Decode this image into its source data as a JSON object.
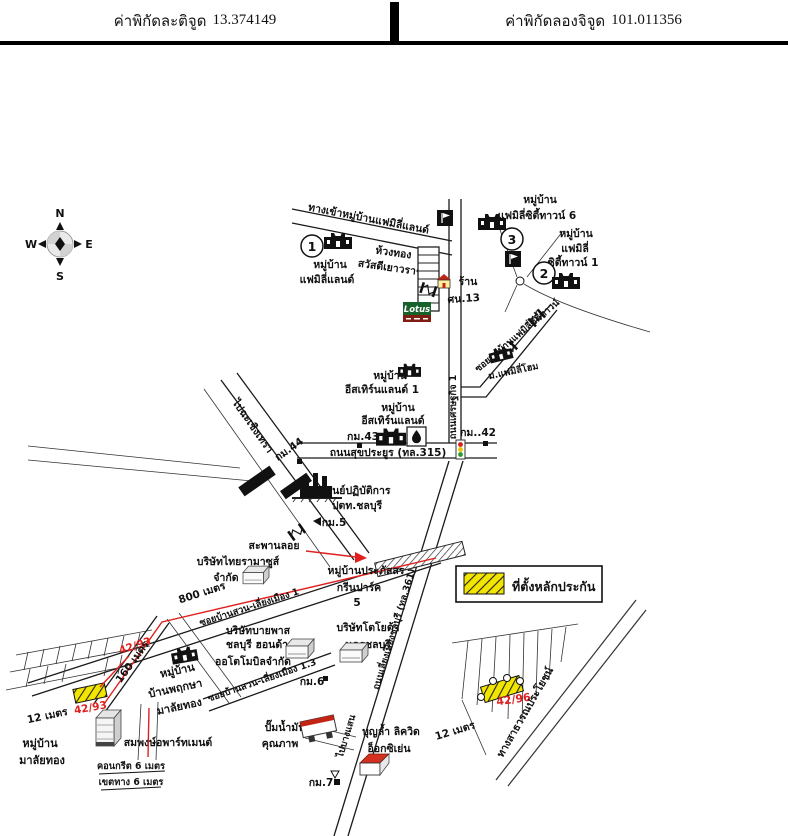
{
  "header": {
    "latitude_label": "ค่าพิกัดละติจูด",
    "latitude_value": "13.374149",
    "longitude_label": "ค่าพิกัดลองจิจูด",
    "longitude_value": "101.011356"
  },
  "compass": {
    "n": "N",
    "s": "S",
    "e": "E",
    "w": "W"
  },
  "legend": {
    "text": "ที่ตั้งหลักประกัน",
    "swatch": "yellow-hatched"
  },
  "colors": {
    "parcel_yellow": "#f2e500",
    "route_red": "#e02020",
    "lotus_green": "#17612a",
    "lotus_band_red": "#7e1d12",
    "signal_red": "#d42020",
    "signal_yellow": "#e8c800",
    "signal_green": "#2a9a2a"
  },
  "icons": {
    "compass_rose": "circle-with-diamond-and-4-arrows",
    "village": "black-gate-building-silhouette",
    "school": "white-pennant-on-black-square",
    "fuel_station": "black-drop-in-square",
    "traffic_light": "red-yellow-green-lights",
    "factory": "black-factory-with-chimneys",
    "km_marker": "black-square",
    "house_shop": "red-roof-house",
    "building_3d": "isometric-white-box",
    "overpass_bridge": "hatched-band",
    "road_break": "double-bar-zigzag"
  },
  "labels": {
    "entrance_road": "ทางเข้าหมู่บ้านแฟมิลี่แลนด์",
    "num1": "1",
    "num2": "2",
    "num3": "3",
    "family_land": [
      "หมู่บ้าน",
      "แฟมิลี่แลนด์"
    ],
    "huang_thong": "ห้วงทอง",
    "sawasdee_yaowarat": "สวัสดีเยาวราช",
    "shop": "ร้าน",
    "shop_no": "ศน.13",
    "lotus": "Lotus",
    "family_city6": [
      "หมู่บ้าน",
      "แฟมิลี่ซิตี้ทาวน์ 6"
    ],
    "family_city1": [
      "หมู่บ้าน",
      "แฟมิลี่",
      "ซิตี้ทาวน์ 1"
    ],
    "soi_family_city": "ซอยหมู่บ้านแฟมิลี่ซิตี้ทาวน์",
    "family_home": "ม.แฟมิลี่โฮม",
    "eastern_land_1": [
      "หมู่บ้าน",
      "อีสเทิร์นแลนด์ 1"
    ],
    "eastern_land": [
      "หมู่บ้าน",
      "อีสเทิร์นแลนด์"
    ],
    "km43": "กม.43",
    "km42": "กม..42",
    "km44": "กม.44",
    "km5": "กม.5",
    "km6": "กม.6",
    "km7": "กม.7",
    "sukprayoon_road": "ถนนสุขประยูร (ทล.315)",
    "setthakit_road": "ถนนเศรษฐกิจ 1",
    "to_chachoengsao": "ไปฉะเชิงเทรา",
    "ptt_center": [
      "ศูนย์ปฏิบัติการ",
      "ปตท.ชลบุรี"
    ],
    "overpass": "สะพานลอย",
    "thai_ramasus": [
      "บริษัทไทยรามาซูส์",
      "จำกัด"
    ],
    "m800": "800 เมตร",
    "soi_bansuan_1": "ซอยบ้านสวน-เลี่ยงเมือง 1",
    "prapatsorn": [
      "หมู่บ้านประภัสสร",
      "กรีนปาร์ค",
      "5"
    ],
    "bypass_honda": [
      "บริษัทบายพาส",
      "ชลบุรี ฮอนด้า",
      "ออโตโมบิลจำกัด"
    ],
    "toyota": [
      "บริษัทโตโยต้า",
      "นครชลบุรี"
    ],
    "soi_bansuan_13": "ซอยบ้านสวน-เลี่ยงเมือง 1.3",
    "liang_mueang_road": "ถนนเลี่ยงเมืองชลบุรี (ทล.361)",
    "gas_station": [
      "ปั๊มน้ำมัน",
      "คุณภาพ"
    ],
    "boonlam": [
      "บุญล้ำ ลิควิด",
      "อ็อกซิเย่น"
    ],
    "to_bangsaen": "ไปบางแสน",
    "route_no": "42/93",
    "parcel_1": "42/93",
    "m160": "160 เมตร",
    "pruksa": [
      "หมู่บ้าน",
      "บ้านพฤกษา",
      "มาลัยทอง"
    ],
    "m12_left": "12 เมตร",
    "malai_thong": [
      "หมู่บ้าน",
      "มาลัยทอง"
    ],
    "sompong": "สมพงษ์อพาร์ทเมนต์",
    "concrete6": "คอนกรีต 6 เมตร",
    "roadway6": "เขตทาง 6 เมตร",
    "parcel_2": "42/96",
    "m12_right": "12 เมตร",
    "public_road": "ทางสาธารณประโยชน์"
  }
}
